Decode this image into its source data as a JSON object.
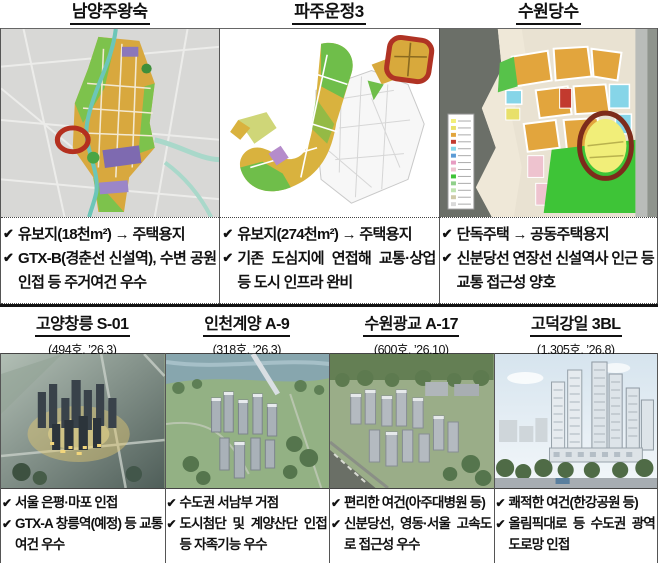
{
  "checkmark": "✔",
  "colors": {
    "annotation_red": "#b4301f",
    "annotation_dark_red": "#7d2b1b",
    "divider_black": "#141414"
  },
  "top_panels": [
    {
      "title": "남양주왕숙",
      "map": "land-use-plan-map-with-red-circle-annotation",
      "bullets": [
        "유보지(18천m²) → 주택용지",
        "GTX-B(경춘선 신설역), 수변 공원 인접 등 주거여건 우수"
      ]
    },
    {
      "title": "파주운정3",
      "map": "land-use-plan-map-with-red-box-annotation",
      "bullets": [
        "유보지(274천m²) → 주택용지",
        "기존 도심지에 연접해 교통·상업 등 도시 인프라 완비"
      ]
    },
    {
      "title": "수원당수",
      "map": "land-use-plan-map-with-red-ellipse-annotation",
      "bullets": [
        "단독주택 → 공동주택용지",
        "신분당선 연장선 신설역사 인근 등 교통 접근성 양호"
      ]
    }
  ],
  "bottom_panels": [
    {
      "title": "고양창릉 S-01",
      "subtitle": "(494호, ’26.3)",
      "photo": "dusk-aerial-rendering-of-apartment-complex",
      "bullets": [
        "서울 은평·마포 인접",
        "GTX-A 창릉역(예정) 등 교통여건 우수"
      ]
    },
    {
      "title": "인천계양 A-9",
      "subtitle": "(318호, ’26.3)",
      "photo": "daytime-aerial-rendering-with-river-and-bridge",
      "bullets": [
        "수도권 서남부 거점",
        "도시첨단 및 계양산단 인접 등 자족기능 우수"
      ]
    },
    {
      "title": "수원광교 A-17",
      "subtitle": "(600호, ’26.10)",
      "photo": "aerial-rendering-of-apartment-towers",
      "bullets": [
        "편리한 여건(아주대병원 등)",
        "신분당선, 영동·서울 고속도로 접근성 우수"
      ]
    },
    {
      "title": "고덕강일 3BL",
      "subtitle": "(1,305호, ’26.8)",
      "photo": "street-level-rendering-of-highrise-towers",
      "bullets": [
        "쾌적한 여건(한강공원 등)",
        "올림픽대로 등 수도권 광역도로망 인접"
      ]
    }
  ]
}
